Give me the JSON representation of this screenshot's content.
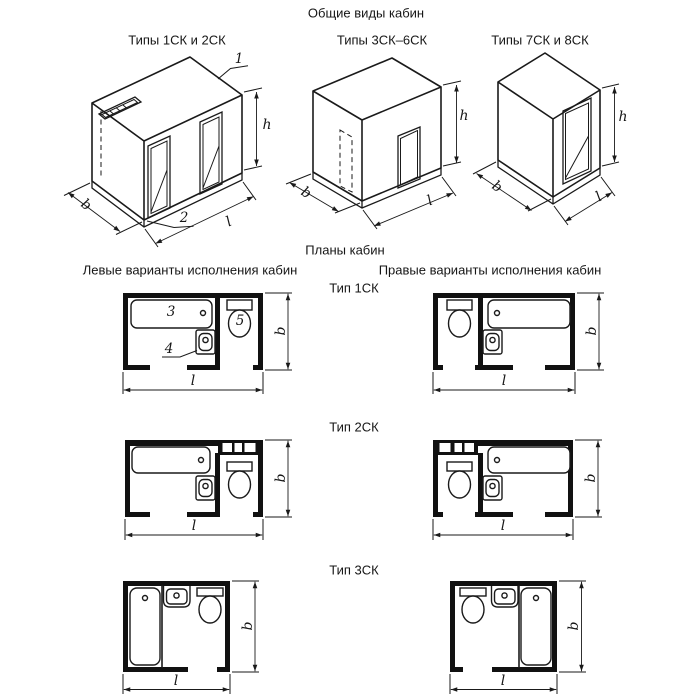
{
  "titles": {
    "general_views": "Общие виды кабин",
    "plans": "Планы кабин"
  },
  "view_groups": {
    "g1": "Типы 1СК и 2СК",
    "g2": "Типы 3СК–6СК",
    "g3": "Типы 7СК и 8СК"
  },
  "plan_headers": {
    "left": "Левые варианты исполнения кабин",
    "right": "Правые варианты исполнения кабин"
  },
  "plan_types": {
    "t1": "Тип 1СК",
    "t2": "Тип 2СК",
    "t3": "Тип 3СК"
  },
  "dim_labels": {
    "h": "h",
    "b": "b",
    "l": "l"
  },
  "callouts": {
    "c1": "1",
    "c2": "2",
    "c3": "3",
    "c4": "4",
    "c5": "5"
  },
  "colors": {
    "line": "#1a1a1a",
    "background": "#ffffff"
  }
}
